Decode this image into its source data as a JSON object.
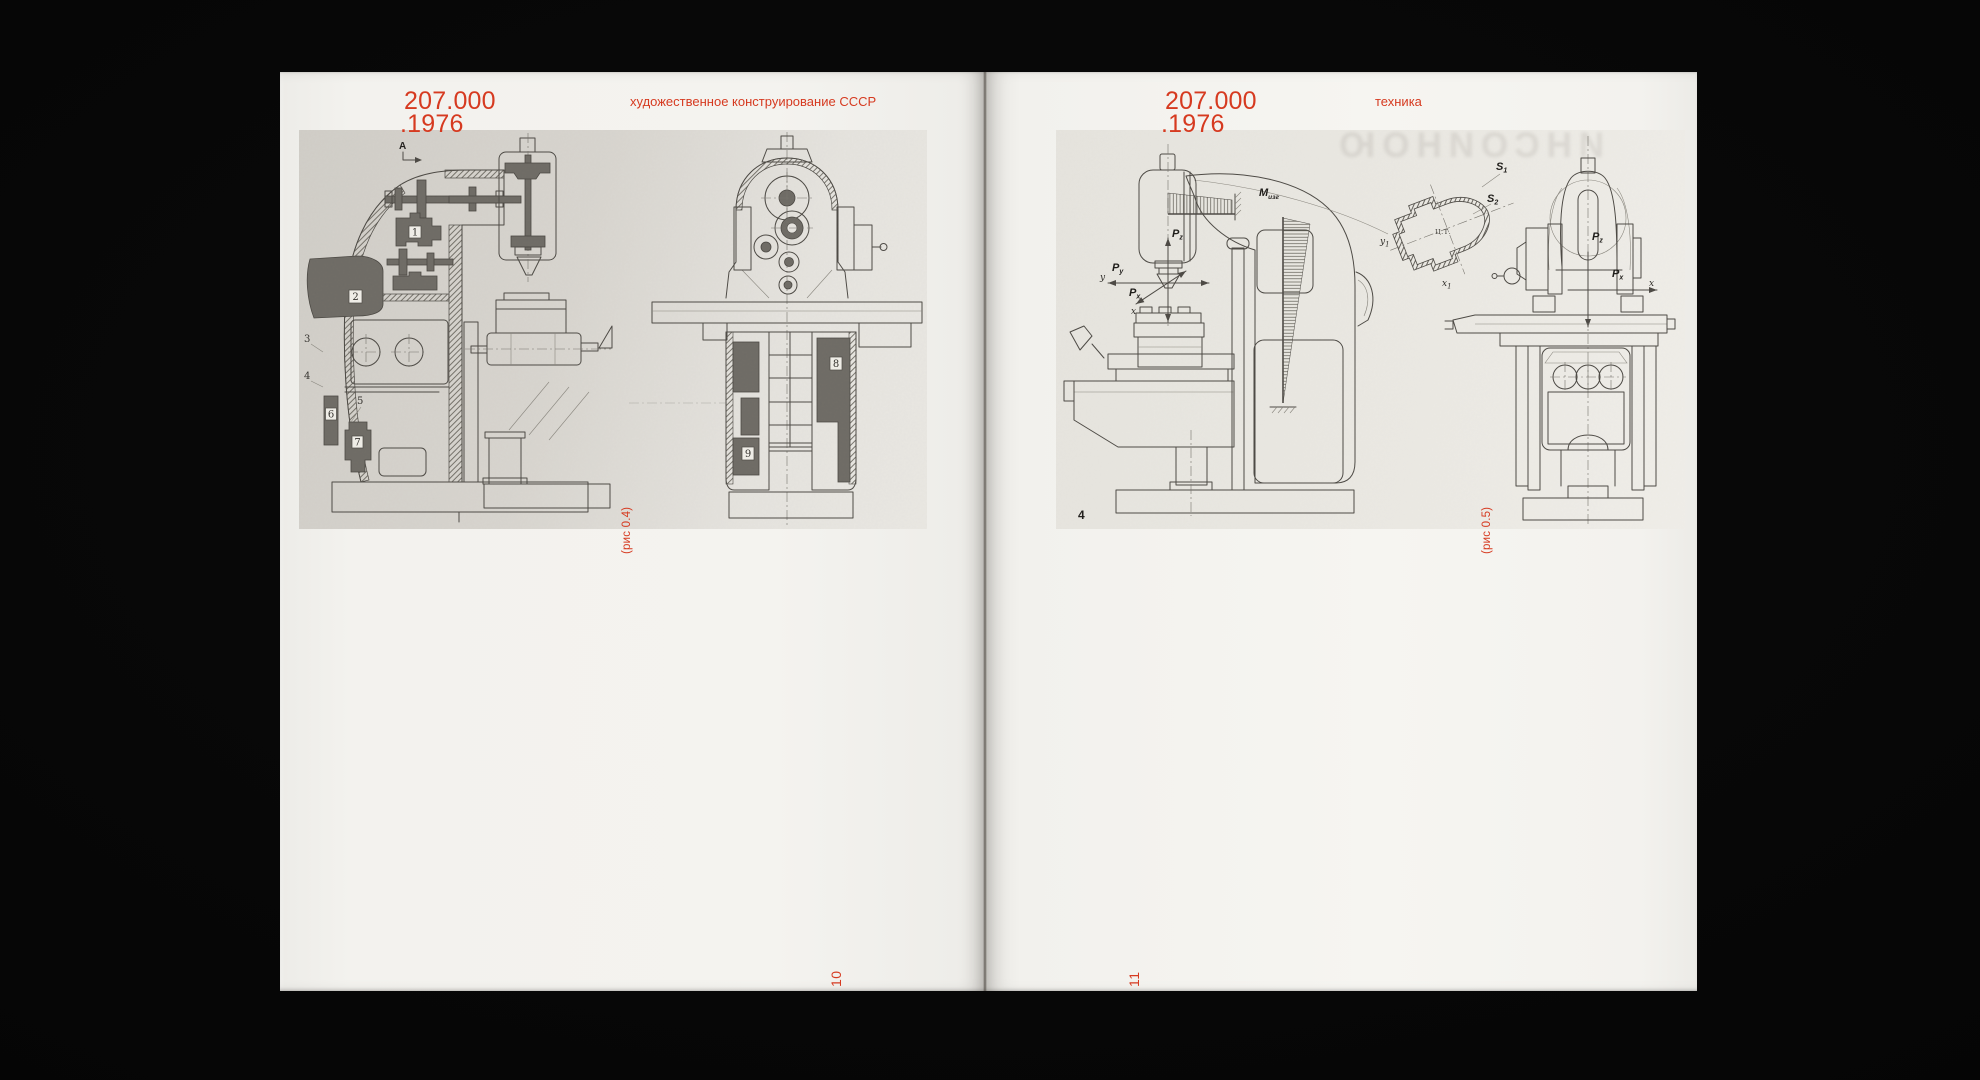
{
  "colors": {
    "accent": "#d63a20",
    "page_left": "#f3f2ee",
    "page_right": "#f5f4f0",
    "plate_left_bg": "#d8d5cf",
    "plate_right_bg": "#ebe9e3",
    "drawing_ink": "#4c4944"
  },
  "left_page": {
    "title_line1": "207.000",
    "title_line2": ".1976",
    "running_head": "художественное конструирование СССР",
    "caption": "(рис 0.4)",
    "page_number": "10",
    "plate": {
      "view_marker": "A",
      "part_numbers": [
        "1",
        "2",
        "3",
        "4",
        "5",
        "6",
        "7",
        "8",
        "9"
      ]
    }
  },
  "right_page": {
    "title_line1": "207.000",
    "title_line2": ".1976",
    "running_head": "техника",
    "caption": "(рис 0.5)",
    "page_number": "11",
    "plate": {
      "figure_number": "4",
      "moment": "M",
      "moment_sub": "изг",
      "force": "P",
      "sub_z": "z",
      "sub_y": "y",
      "sub_x": "x",
      "axis_y": "y",
      "axis_x": "x",
      "section": "S",
      "sub_1": "1",
      "sub_2": "2",
      "center_of_gravity": "Ц.Т.",
      "show_through": "ИНСОИНОЮ"
    }
  }
}
